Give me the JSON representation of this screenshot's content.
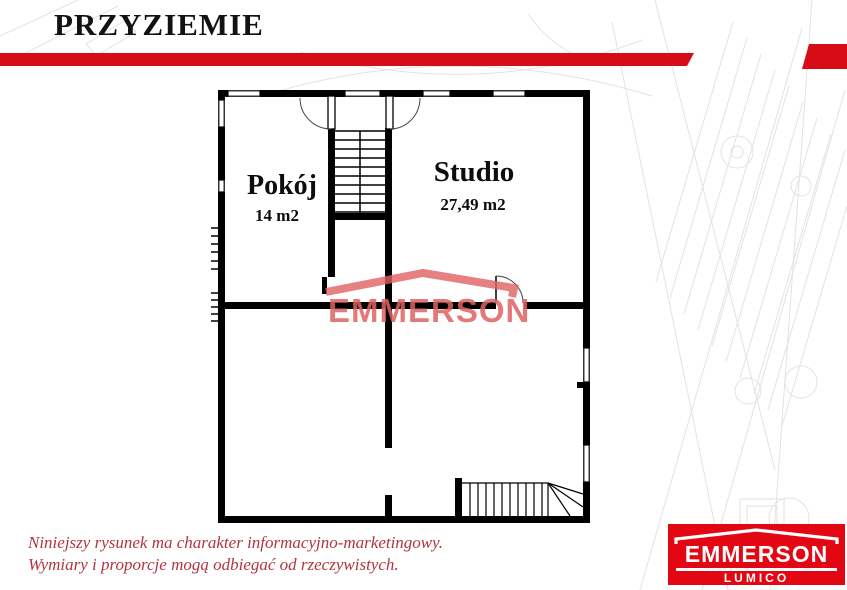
{
  "header": {
    "title": "PRZYZIEMIE"
  },
  "plan": {
    "rooms": [
      {
        "name": "Pokój",
        "area": "14 m2"
      },
      {
        "name": "Studio",
        "area": "27,49 m2"
      }
    ],
    "watermark_text": "EMMERSON"
  },
  "footer": {
    "disclaimer": {
      "line1": "Niniejszy rysunek ma charakter informacyjno-marketingowy.",
      "line2": "Wymiary i proporcje mogą odbiegać od rzeczywistych."
    },
    "logo": {
      "brand": "EMMERSON",
      "subbrand": "LUMICO"
    }
  },
  "colors": {
    "accent_red": "#d60d17",
    "logo_red": "#e30613",
    "watermark_red": "#e06262",
    "disclaimer_red": "#b03540",
    "wall_black": "#000000",
    "blueprint_gray": "#e2e2e2"
  }
}
